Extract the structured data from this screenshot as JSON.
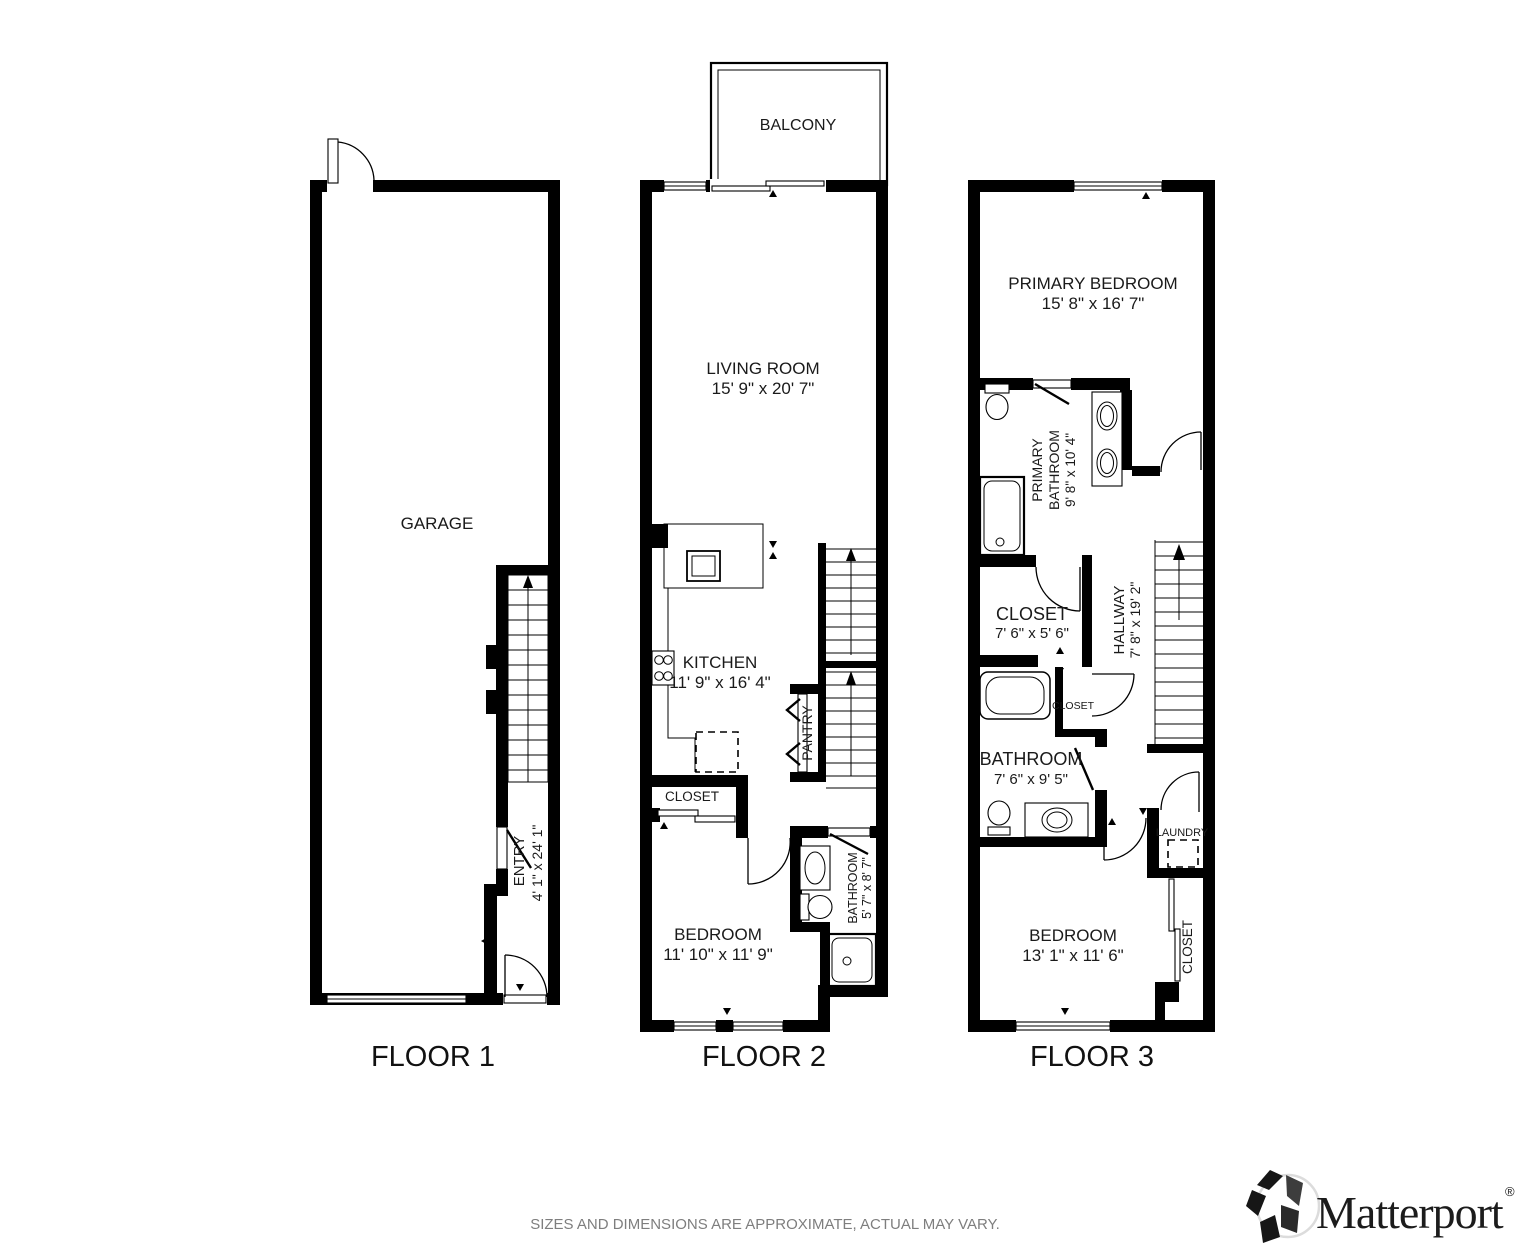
{
  "floors": [
    {
      "label": "FLOOR 1",
      "rooms": {
        "garage": {
          "name": "GARAGE"
        },
        "entry": {
          "name": "ENTRY",
          "dims": "4' 1\" x 24' 1\""
        }
      }
    },
    {
      "label": "FLOOR 2",
      "rooms": {
        "balcony": {
          "name": "BALCONY"
        },
        "living_room": {
          "name": "LIVING ROOM",
          "dims": "15' 9\" x 20' 7\""
        },
        "kitchen": {
          "name": "KITCHEN",
          "dims": "11' 9\" x 16' 4\""
        },
        "pantry": {
          "name": "PANTRY"
        },
        "closet": {
          "name": "CLOSET"
        },
        "bedroom": {
          "name": "BEDROOM",
          "dims": "11' 10\" x 11' 9\""
        },
        "bathroom": {
          "name": "BATHROOM",
          "dims": "5' 7\" x 8' 7\""
        }
      }
    },
    {
      "label": "FLOOR 3",
      "rooms": {
        "primary_bedroom": {
          "name": "PRIMARY BEDROOM",
          "dims": "15' 8\" x 16' 7\""
        },
        "primary_bathroom": {
          "name": "PRIMARY BATHROOM",
          "name_lines": [
            "PRIMARY",
            "BATHROOM"
          ],
          "dims": "9' 8\" x 10' 4\""
        },
        "closet": {
          "name": "CLOSET",
          "dims": "7' 6\" x 5' 6\""
        },
        "hallway": {
          "name": "HALLWAY",
          "dims": "7' 8\" x 19' 2\""
        },
        "hall_closet": {
          "name": "CLOSET"
        },
        "bathroom": {
          "name": "BATHROOM",
          "dims": "7' 6\" x 9' 5\""
        },
        "laundry": {
          "name": "LAUNDRY"
        },
        "bedroom": {
          "name": "BEDROOM",
          "dims": "13' 1\" x 11' 6\""
        },
        "bedroom_closet": {
          "name": "CLOSET"
        }
      }
    }
  ],
  "footer": {
    "disclaimer": "SIZES AND DIMENSIONS ARE APPROXIMATE, ACTUAL MAY VARY."
  },
  "logo": {
    "brand": "Matterport",
    "registered": "®"
  },
  "colors": {
    "wall": "#000000",
    "text": "#1a1a1a",
    "disclaimer_text": "#7e7e7e",
    "background": "#ffffff"
  }
}
